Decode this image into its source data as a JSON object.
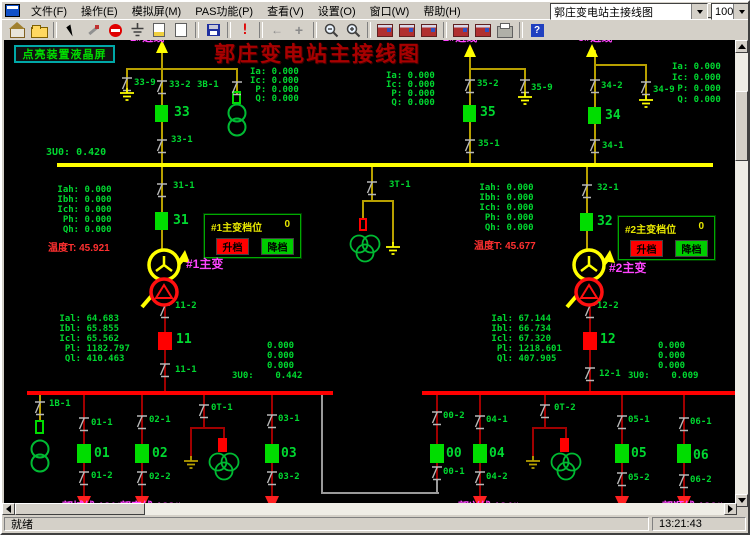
{
  "menu": {
    "items": [
      "文件(F)",
      "操作(E)",
      "模拟屏(M)",
      "PAS功能(P)",
      "查看(V)",
      "设置(O)",
      "窗口(W)",
      "帮助(H)"
    ]
  },
  "window_controls": {
    "minimize": "minimize",
    "restore": "restore",
    "close": "×"
  },
  "toolbar": {
    "icons": [
      "home",
      "open",
      "sep",
      "cursor",
      "tools",
      "stop",
      "ground",
      "page-color",
      "page-new",
      "sep",
      "save",
      "sep",
      "alert",
      "sep",
      "nav-back",
      "add",
      "sep",
      "zoom-out",
      "zoom-in",
      "sep",
      "device-1",
      "device-2",
      "device-3",
      "sep",
      "device-4",
      "device-5",
      "printer",
      "sep",
      "help"
    ],
    "view_combo_value": "郭庄变电站主接线图",
    "zoom_combo_value": "100%"
  },
  "statusbar": {
    "ready": "就绪",
    "time": "13:21:43"
  },
  "scada": {
    "title": "郭庄变电站主接线图",
    "lcd_button_label": "点亮装置液晶屏",
    "tap_panels": [
      {
        "title": "#1主变档位",
        "value": "0",
        "up_label": "升档",
        "down_label": "降档"
      },
      {
        "title": "#2主变档位",
        "value": "0",
        "up_label": "升档",
        "down_label": "降档"
      }
    ],
    "colors": {
      "g": "#00d830",
      "G": "#00dd00",
      "Y": "#ffff00",
      "o": "#b8a000",
      "r": "#ff3030",
      "R": "#ff0000",
      "D": "#a00000",
      "m": "#ff44ff",
      "gy": "#9a9a9a"
    },
    "lines": [
      [
        159,
        44,
        2,
        119,
        "o"
      ],
      [
        124,
        66,
        112,
        2,
        "o"
      ],
      [
        124,
        66,
        2,
        20,
        "o"
      ],
      [
        234,
        66,
        2,
        26,
        "o"
      ],
      [
        467,
        48,
        2,
        115,
        "o"
      ],
      [
        467,
        66,
        57,
        2,
        "o"
      ],
      [
        522,
        66,
        2,
        24,
        "o"
      ],
      [
        592,
        48,
        2,
        115,
        "o"
      ],
      [
        592,
        62,
        53,
        2,
        "o"
      ],
      [
        643,
        62,
        2,
        31,
        "o"
      ],
      [
        55,
        161,
        656,
        4,
        "Y"
      ],
      [
        159,
        165,
        2,
        84,
        "o"
      ],
      [
        584,
        165,
        2,
        84,
        "o"
      ],
      [
        369,
        165,
        2,
        35,
        "o"
      ],
      [
        360,
        198,
        32,
        2,
        "o"
      ],
      [
        360,
        198,
        2,
        20,
        "o"
      ],
      [
        390,
        198,
        2,
        44,
        "o"
      ],
      [
        37,
        393,
        2,
        27,
        "o"
      ],
      [
        162,
        302,
        2,
        89,
        "D"
      ],
      [
        587,
        302,
        2,
        89,
        "D"
      ],
      [
        25,
        389,
        306,
        4,
        "R"
      ],
      [
        420,
        389,
        314,
        4,
        "R"
      ],
      [
        81,
        393,
        2,
        104,
        "D"
      ],
      [
        139,
        393,
        2,
        104,
        "D"
      ],
      [
        269,
        393,
        2,
        104,
        "D"
      ],
      [
        477,
        393,
        2,
        104,
        "D"
      ],
      [
        619,
        393,
        2,
        104,
        "D"
      ],
      [
        681,
        393,
        2,
        104,
        "D"
      ],
      [
        434,
        393,
        2,
        87,
        "D"
      ],
      [
        201,
        393,
        2,
        33,
        "D"
      ],
      [
        188,
        425,
        35,
        2,
        "D"
      ],
      [
        188,
        425,
        2,
        31,
        "D"
      ],
      [
        221,
        425,
        2,
        13,
        "D"
      ],
      [
        542,
        393,
        2,
        33,
        "D"
      ],
      [
        530,
        425,
        35,
        2,
        "D"
      ],
      [
        530,
        425,
        2,
        31,
        "D"
      ],
      [
        563,
        425,
        2,
        13,
        "D"
      ],
      [
        319,
        393,
        2,
        99,
        "gy"
      ],
      [
        319,
        490,
        118,
        2,
        "gy"
      ],
      [
        434,
        477,
        2,
        15,
        "gy"
      ]
    ],
    "breakers": [
      [
        153,
        103,
        13,
        17,
        "G",
        "breaker-33"
      ],
      [
        461,
        103,
        13,
        17,
        "G",
        "breaker-35"
      ],
      [
        586,
        105,
        13,
        17,
        "G",
        "breaker-34"
      ],
      [
        153,
        210,
        13,
        18,
        "G",
        "breaker-31"
      ],
      [
        578,
        211,
        13,
        18,
        "G",
        "breaker-32"
      ],
      [
        156,
        330,
        14,
        18,
        "R",
        "breaker-11"
      ],
      [
        581,
        330,
        14,
        18,
        "R",
        "breaker-12"
      ],
      [
        75,
        442,
        14,
        19,
        "G",
        "breaker-01"
      ],
      [
        133,
        442,
        14,
        19,
        "G",
        "breaker-02"
      ],
      [
        263,
        442,
        14,
        19,
        "G",
        "breaker-03"
      ],
      [
        428,
        442,
        14,
        19,
        "G",
        "breaker-00"
      ],
      [
        471,
        442,
        14,
        19,
        "G",
        "breaker-04"
      ],
      [
        613,
        442,
        14,
        19,
        "G",
        "breaker-05"
      ],
      [
        675,
        442,
        14,
        19,
        "G",
        "breaker-06"
      ]
    ],
    "fuses": [
      [
        230,
        89,
        9,
        13,
        "G",
        0
      ],
      [
        33,
        418,
        9,
        14,
        "G",
        0
      ],
      [
        357,
        216,
        8,
        13,
        "R",
        0
      ],
      [
        216,
        436,
        9,
        14,
        "R",
        1
      ],
      [
        558,
        436,
        9,
        14,
        "R",
        1
      ]
    ],
    "switches": [
      [
        125,
        76
      ],
      [
        160,
        79
      ],
      [
        235,
        80
      ],
      [
        160,
        138
      ],
      [
        468,
        78
      ],
      [
        523,
        78
      ],
      [
        468,
        138
      ],
      [
        593,
        78
      ],
      [
        644,
        80
      ],
      [
        593,
        138
      ],
      [
        160,
        182
      ],
      [
        370,
        180
      ],
      [
        585,
        183
      ],
      [
        163,
        303
      ],
      [
        163,
        362
      ],
      [
        588,
        303
      ],
      [
        588,
        366
      ],
      [
        38,
        400
      ],
      [
        82,
        416
      ],
      [
        82,
        470
      ],
      [
        140,
        414
      ],
      [
        140,
        470
      ],
      [
        202,
        403
      ],
      [
        270,
        413
      ],
      [
        270,
        470
      ],
      [
        435,
        410
      ],
      [
        435,
        465
      ],
      [
        478,
        414
      ],
      [
        478,
        470
      ],
      [
        543,
        403
      ],
      [
        620,
        414
      ],
      [
        620,
        471
      ],
      [
        682,
        416
      ],
      [
        682,
        473
      ]
    ],
    "grounds": [
      [
        125,
        86,
        "Y"
      ],
      [
        523,
        90,
        "Y"
      ],
      [
        644,
        93,
        "Y"
      ],
      [
        391,
        240,
        "Y"
      ],
      [
        189,
        454,
        "o"
      ],
      [
        531,
        454,
        "o"
      ]
    ],
    "arrows_up": [
      [
        160,
        38
      ],
      [
        468,
        42
      ],
      [
        590,
        42
      ]
    ],
    "arrows_down": [
      [
        82,
        494
      ],
      [
        140,
        494
      ],
      [
        270,
        494
      ],
      [
        478,
        494
      ],
      [
        620,
        494
      ],
      [
        682,
        494
      ]
    ],
    "transformers": [
      [
        "main",
        162,
        246
      ],
      [
        "main",
        587,
        246
      ],
      [
        "pt2",
        235,
        101
      ],
      [
        "pt2",
        38,
        437
      ],
      [
        "pt3",
        363,
        232
      ],
      [
        "pt3",
        222,
        450
      ],
      [
        "pt3",
        564,
        450
      ]
    ],
    "texts": [
      [
        "Ia: 0.000",
        248,
        66
      ],
      [
        "Ic: 0.000",
        248,
        75
      ],
      [
        " P: 0.000",
        248,
        84
      ],
      [
        " Q: 0.000",
        248,
        93
      ],
      [
        "Ia: 0.000",
        384,
        70
      ],
      [
        "Ic: 0.000",
        384,
        79
      ],
      [
        " P: 0.000",
        384,
        88
      ],
      [
        " Q: 0.000",
        384,
        97
      ],
      [
        "Ia: 0.000",
        670,
        61
      ],
      [
        "Ic: 0.000",
        670,
        72
      ],
      [
        " P: 0.000",
        670,
        83
      ],
      [
        " Q: 0.000",
        670,
        94
      ],
      [
        "3U0: 0.420",
        44,
        146,
        "g",
        10
      ],
      [
        " Iah: 0.000",
        50,
        184
      ],
      [
        " Ibh: 0.000",
        50,
        194
      ],
      [
        " Ich: 0.000",
        50,
        204
      ],
      [
        "  Ph: 0.000",
        50,
        214
      ],
      [
        "  Qh: 0.000",
        50,
        224
      ],
      [
        "温度T: 45.921",
        46,
        242,
        "r",
        10,
        1
      ],
      [
        " Iah: 0.000",
        472,
        182
      ],
      [
        " Ibh: 0.000",
        472,
        192
      ],
      [
        " Ich: 0.000",
        472,
        202
      ],
      [
        "  Ph: 0.000",
        472,
        212
      ],
      [
        "  Qh: 0.000",
        472,
        222
      ],
      [
        "温度T: 45.677",
        472,
        240,
        "r",
        10,
        1
      ],
      [
        " Ial: 64.683",
        52,
        313
      ],
      [
        " Ibl: 65.855",
        52,
        323
      ],
      [
        " Icl: 65.562",
        52,
        333
      ],
      [
        "  Pl: 1182.797",
        52,
        343
      ],
      [
        "  Ql: 410.463",
        52,
        353
      ],
      [
        " Ial: 67.144",
        484,
        313
      ],
      [
        " Ibl: 66.734",
        484,
        323
      ],
      [
        " Icl: 67.320",
        484,
        333
      ],
      [
        "  Pl: 1218.601",
        484,
        343
      ],
      [
        "  Ql: 407.905",
        484,
        353
      ],
      [
        "0.000",
        265,
        340
      ],
      [
        "0.000",
        265,
        350
      ],
      [
        "0.000",
        265,
        360
      ],
      [
        "3U0:    0.442",
        230,
        370
      ],
      [
        "0.000",
        656,
        340
      ],
      [
        "0.000",
        656,
        350
      ],
      [
        "0.000",
        656,
        360
      ],
      [
        "3U0:    0.009",
        626,
        370
      ],
      [
        "33-9",
        132,
        77
      ],
      [
        "33-2",
        167,
        79
      ],
      [
        "3B-1",
        195,
        79
      ],
      [
        "33-1",
        169,
        134
      ],
      [
        "35-2",
        475,
        78
      ],
      [
        "35-9",
        529,
        82
      ],
      [
        "35-1",
        476,
        138
      ],
      [
        "34-2",
        599,
        80
      ],
      [
        "34-9",
        651,
        84
      ],
      [
        "34-1",
        600,
        140
      ],
      [
        "31-1",
        171,
        180
      ],
      [
        "3T-1",
        387,
        179
      ],
      [
        "32-1",
        595,
        182
      ],
      [
        "11-2",
        173,
        300
      ],
      [
        "11-1",
        173,
        364
      ],
      [
        "12-2",
        595,
        300
      ],
      [
        "12-1",
        597,
        368
      ],
      [
        "1B-1",
        47,
        398
      ],
      [
        "01-1",
        89,
        417
      ],
      [
        "01-2",
        89,
        470
      ],
      [
        "02-1",
        147,
        414
      ],
      [
        "02-2",
        147,
        471
      ],
      [
        "0T-1",
        209,
        402
      ],
      [
        "03-1",
        276,
        413
      ],
      [
        "03-2",
        276,
        471
      ],
      [
        "00-2",
        441,
        410
      ],
      [
        "00-1",
        441,
        466
      ],
      [
        "04-1",
        484,
        414
      ],
      [
        "04-2",
        484,
        471
      ],
      [
        "0T-2",
        552,
        402
      ],
      [
        "05-1",
        626,
        414
      ],
      [
        "05-2",
        626,
        472
      ],
      [
        "06-1",
        688,
        416
      ],
      [
        "06-2",
        688,
        474
      ],
      [
        "33",
        172,
        104,
        "g",
        13
      ],
      [
        "35",
        478,
        104,
        "g",
        13
      ],
      [
        "34",
        603,
        107,
        "g",
        13
      ],
      [
        "31",
        171,
        212,
        "g",
        13
      ],
      [
        "32",
        595,
        213,
        "g",
        13
      ],
      [
        "11",
        174,
        331,
        "g",
        13
      ],
      [
        "12",
        598,
        331,
        "g",
        13
      ],
      [
        "01",
        92,
        445,
        "g",
        13
      ],
      [
        "02",
        150,
        445,
        "g",
        13
      ],
      [
        "03",
        279,
        445,
        "g",
        13
      ],
      [
        "00",
        444,
        445,
        "g",
        13
      ],
      [
        "04",
        487,
        445,
        "g",
        13
      ],
      [
        "05",
        629,
        445,
        "g",
        13
      ],
      [
        "06",
        691,
        447,
        "g",
        13
      ],
      [
        "#1主变",
        184,
        256,
        "m",
        12,
        1
      ],
      [
        "#2主变",
        607,
        260,
        "m",
        12,
        1
      ],
      [
        "1#进线",
        128,
        31,
        "m",
        11,
        1
      ],
      [
        "2#进线",
        441,
        31,
        "m",
        11,
        1
      ],
      [
        "3#进线",
        576,
        31,
        "m",
        11,
        1
      ],
      [
        "郭城线 131#",
        60,
        500,
        "m",
        11,
        1
      ],
      [
        "郭安线 132#",
        118,
        500,
        "m",
        11,
        1
      ],
      [
        "郭兴线 134#",
        456,
        500,
        "m",
        11,
        1
      ],
      [
        "郭顺线 136#",
        660,
        500,
        "m",
        11,
        1
      ]
    ]
  }
}
